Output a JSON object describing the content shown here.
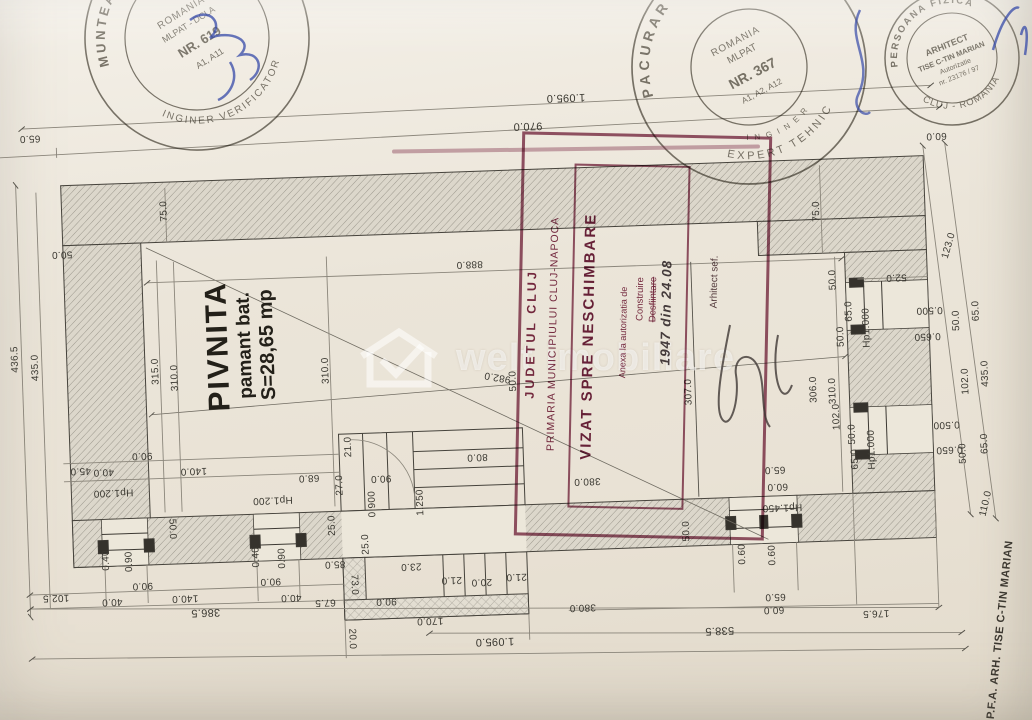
{
  "room": {
    "name": "PIVNITA",
    "subtitle": "pamant bat.",
    "area": "S=28,65 mp"
  },
  "watermark": {
    "text": "welt imobiliare"
  },
  "side_label": "P.F.A. ARH. TISE C-TIN MARIAN",
  "colors": {
    "stamp_maroon": "#7d2c48",
    "pen_blue": "#3549a8",
    "ink": "#3a3831",
    "paper": "#ebe5d9"
  },
  "stamps": {
    "verifier": {
      "arc_top": "MUNTEANU M. MARIAN",
      "arc_bottom": "INGINER  VERIFICATOR",
      "line1": "ROMANIA",
      "line2": "MLPAT - DCLA",
      "line3": "NR. 619",
      "line4": "A1, A11"
    },
    "expert": {
      "arc_top": "PACURAR V. VASILE",
      "arc_bottom": "EXPERT TEHNIC",
      "arc_inner": "I N G I N E R",
      "line1": "ROMANIA",
      "line2": "MLPAT",
      "line3": "NR. 367",
      "line4": "A1, A2, A12"
    },
    "architect": {
      "arc_top": "PERSOANA FIZICA",
      "arc_bottom": "CLUJ - ROMANIA",
      "line1": "ARHITECT",
      "line2": "TISE C-TIN MARIAN",
      "line3": "Autorizatie",
      "line4": "nr. 23176 / 97"
    },
    "cityhall": {
      "col1": "JUDETUL CLUJ",
      "col2": "PRIMARIA MUNICIPIULUI CLUJ-NAPOCA",
      "title": "VIZAT SPRE NESCHIMBARE",
      "note1": "Anexa la autorizatia de",
      "note2": "Construire",
      "note3": "Desfiintare",
      "handwritten": "1947 din 24.08",
      "signoff": "Arhitect sef."
    }
  },
  "dimensions": [
    {
      "t": "65.0",
      "x": 38,
      "y": 121,
      "r": 180
    },
    {
      "t": "1.095.0",
      "x": 575,
      "y": 99,
      "r": 180,
      "s": 11
    },
    {
      "t": "970.0",
      "x": 536,
      "y": 126,
      "r": 180,
      "s": 11
    },
    {
      "t": "60.0",
      "x": 944,
      "y": 150,
      "r": 180
    },
    {
      "t": "75.0",
      "x": 170,
      "y": 199,
      "r": -90
    },
    {
      "t": "50.0",
      "x": 66,
      "y": 238,
      "r": 180
    },
    {
      "t": "888.0",
      "x": 473,
      "y": 262,
      "r": 180
    },
    {
      "t": "75.0",
      "x": 822,
      "y": 222,
      "r": -90
    },
    {
      "t": "123.0",
      "x": 953,
      "y": 261,
      "r": -72
    },
    {
      "t": "52.0",
      "x": 899,
      "y": 290,
      "r": 180
    },
    {
      "t": "982.0",
      "x": 497,
      "y": 376,
      "r": 192
    },
    {
      "t": "436.5",
      "x": 16,
      "y": 342,
      "r": -90
    },
    {
      "t": "435.0",
      "x": 36,
      "y": 351,
      "r": -90
    },
    {
      "t": "315.0",
      "x": 156,
      "y": 359,
      "r": -90
    },
    {
      "t": "310.0",
      "x": 175,
      "y": 366,
      "r": -90
    },
    {
      "t": "310.0",
      "x": 326,
      "y": 364,
      "r": -90
    },
    {
      "t": "90.0",
      "x": 139,
      "y": 442,
      "r": 180
    },
    {
      "t": "45.0",
      "x": 77,
      "y": 455,
      "r": 180
    },
    {
      "t": "40.0",
      "x": 100,
      "y": 457,
      "r": 180
    },
    {
      "t": "140.0",
      "x": 190,
      "y": 459,
      "r": 180
    },
    {
      "t": "Hp1.200",
      "x": 109,
      "y": 478,
      "r": 180
    },
    {
      "t": "50.0",
      "x": 166,
      "y": 517,
      "r": 90
    },
    {
      "t": "0.40",
      "x": 100,
      "y": 546,
      "r": -90
    },
    {
      "t": "0.90",
      "x": 123,
      "y": 548,
      "r": -90
    },
    {
      "t": "90.0",
      "x": 135,
      "y": 572,
      "r": 180
    },
    {
      "t": "40.0",
      "x": 104,
      "y": 587,
      "r": 180
    },
    {
      "t": "140.0",
      "x": 177,
      "y": 586,
      "r": 180
    },
    {
      "t": "102.5",
      "x": 48,
      "y": 581,
      "r": 180
    },
    {
      "t": "386.5",
      "x": 197,
      "y": 601,
      "r": 180,
      "s": 11
    },
    {
      "t": "68.0",
      "x": 305,
      "y": 470,
      "r": 180
    },
    {
      "t": "90.0",
      "x": 377,
      "y": 473,
      "r": 180
    },
    {
      "t": "21.0",
      "x": 346,
      "y": 441,
      "r": -90
    },
    {
      "t": "27.0",
      "x": 336,
      "y": 479,
      "r": -90
    },
    {
      "t": "Hp1.200",
      "x": 268,
      "y": 491,
      "r": 180
    },
    {
      "t": "0.900",
      "x": 368,
      "y": 499,
      "r": -90
    },
    {
      "t": "1.250",
      "x": 416,
      "y": 499,
      "r": -90
    },
    {
      "t": "25.0",
      "x": 327,
      "y": 519,
      "r": -90
    },
    {
      "t": "25.0",
      "x": 360,
      "y": 539,
      "r": -90
    },
    {
      "t": "80.0",
      "x": 474,
      "y": 455,
      "r": 180
    },
    {
      "t": "0.40",
      "x": 250,
      "y": 548,
      "r": -90
    },
    {
      "t": "0.90",
      "x": 276,
      "y": 550,
      "r": -90
    },
    {
      "t": "90.0",
      "x": 263,
      "y": 572,
      "r": 180
    },
    {
      "t": "40.0",
      "x": 283,
      "y": 589,
      "r": 180
    },
    {
      "t": "67.5",
      "x": 317,
      "y": 595,
      "r": 180
    },
    {
      "t": "85.0",
      "x": 328,
      "y": 557,
      "r": 180
    },
    {
      "t": "73.0",
      "x": 346,
      "y": 579,
      "r": 90
    },
    {
      "t": "23.0",
      "x": 404,
      "y": 562,
      "r": 180
    },
    {
      "t": "21.0",
      "x": 444,
      "y": 577,
      "r": 180
    },
    {
      "t": "20.0",
      "x": 474,
      "y": 580,
      "r": 180
    },
    {
      "t": "21.0",
      "x": 509,
      "y": 576,
      "r": 180
    },
    {
      "t": "90.0",
      "x": 378,
      "y": 596,
      "r": 180
    },
    {
      "t": "170.0",
      "x": 421,
      "y": 617,
      "r": 180
    },
    {
      "t": "20.0",
      "x": 342,
      "y": 633,
      "r": 90
    },
    {
      "t": "1.095.0",
      "x": 485,
      "y": 640,
      "r": 180,
      "s": 11
    },
    {
      "t": "50.0",
      "x": 681,
      "y": 537,
      "r": -90
    },
    {
      "t": "0.60",
      "x": 736,
      "y": 562,
      "r": -90
    },
    {
      "t": "0.60",
      "x": 766,
      "y": 564,
      "r": -90
    },
    {
      "t": "65.0",
      "x": 767,
      "y": 605,
      "r": 180
    },
    {
      "t": "60.0",
      "x": 765,
      "y": 618,
      "r": 180
    },
    {
      "t": "380.0",
      "x": 574,
      "y": 609,
      "r": 180
    },
    {
      "t": "176.5",
      "x": 867,
      "y": 625,
      "r": 180
    },
    {
      "t": "538.5",
      "x": 710,
      "y": 637,
      "r": 180,
      "s": 11
    },
    {
      "t": "65.0",
      "x": 771,
      "y": 478,
      "r": 180
    },
    {
      "t": "60.0",
      "x": 773,
      "y": 495,
      "r": 180
    },
    {
      "t": "Hp1.450",
      "x": 777,
      "y": 516,
      "r": 180
    },
    {
      "t": "380.0",
      "x": 583,
      "y": 483,
      "r": 180
    },
    {
      "t": "50.0",
      "x": 513,
      "y": 381,
      "r": -90
    },
    {
      "t": "307.0",
      "x": 688,
      "y": 398,
      "r": -90
    },
    {
      "t": "306.0",
      "x": 813,
      "y": 400,
      "r": -90
    },
    {
      "t": "310.0",
      "x": 832,
      "y": 402,
      "r": -90
    },
    {
      "t": "102.0",
      "x": 835,
      "y": 428,
      "r": -90
    },
    {
      "t": "50.0",
      "x": 836,
      "y": 291,
      "r": -90
    },
    {
      "t": "65.0",
      "x": 851,
      "y": 323,
      "r": -90
    },
    {
      "t": "50.0",
      "x": 842,
      "y": 348,
      "r": -90
    },
    {
      "t": "Hp1.000",
      "x": 868,
      "y": 340,
      "r": -90
    },
    {
      "t": "0.500",
      "x": 931,
      "y": 324,
      "r": 180
    },
    {
      "t": "0.650",
      "x": 928,
      "y": 350,
      "r": 180
    },
    {
      "t": "50.0",
      "x": 958,
      "y": 336,
      "r": -90
    },
    {
      "t": "65.0",
      "x": 978,
      "y": 327,
      "r": -90
    },
    {
      "t": "102.0",
      "x": 965,
      "y": 397,
      "r": -90
    },
    {
      "t": "435.0",
      "x": 985,
      "y": 390,
      "r": -90
    },
    {
      "t": "50.0",
      "x": 850,
      "y": 446,
      "r": -90
    },
    {
      "t": "65.0",
      "x": 852,
      "y": 471,
      "r": -90
    },
    {
      "t": "Hp1.000",
      "x": 869,
      "y": 462,
      "r": -90
    },
    {
      "t": "0.500",
      "x": 944,
      "y": 439,
      "r": 180
    },
    {
      "t": "0.650",
      "x": 946,
      "y": 464,
      "r": 180
    },
    {
      "t": "65.0",
      "x": 982,
      "y": 460,
      "r": -90
    },
    {
      "t": "50.0",
      "x": 960,
      "y": 469,
      "r": -90
    },
    {
      "t": "110.0",
      "x": 981,
      "y": 520,
      "r": -75
    }
  ]
}
